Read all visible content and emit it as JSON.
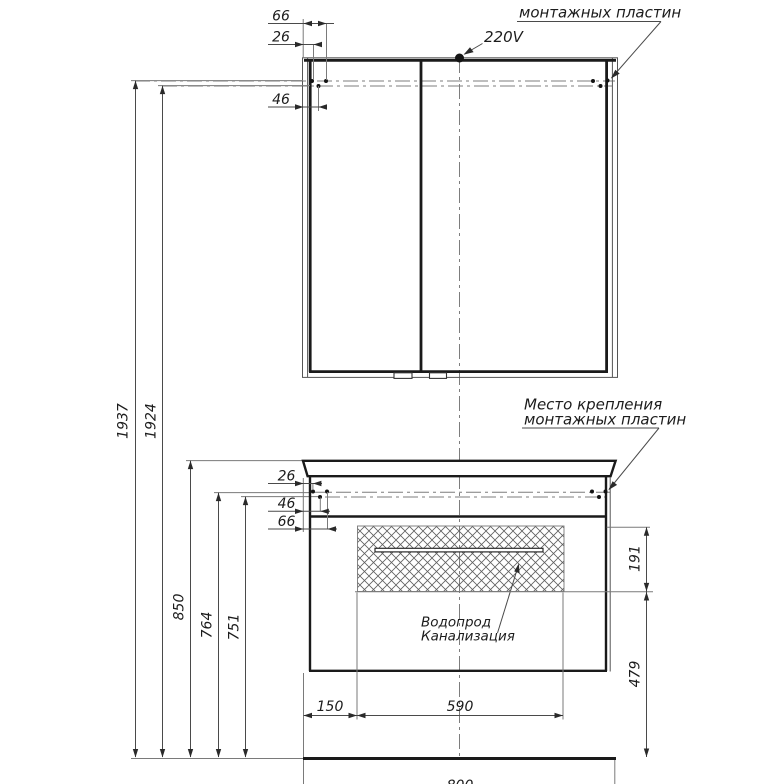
{
  "drawing": {
    "type": "furniture installation technical drawing",
    "units": "mm",
    "annotations": {
      "power": "220V",
      "mounting_plates_top": "монтажных пластин",
      "mounting_place_line1": "Место крепления",
      "mounting_place_line2": "монтажных пластин",
      "utilities_line1": "Водопрод",
      "utilities_line2": "Канализация"
    },
    "dims": {
      "mirror_top": {
        "d66": "66",
        "d26": "26",
        "d46": "46"
      },
      "heights": {
        "d1937": "1937",
        "d1924": "1924",
        "d850": "850",
        "d764": "764",
        "d751": "751"
      },
      "vanity_left": {
        "d26": "26",
        "d46": "46",
        "d66": "66"
      },
      "vanity_right": {
        "d191": "191",
        "d479": "479"
      },
      "widths": {
        "d150": "150",
        "d590": "590",
        "d800": "800"
      }
    },
    "colors": {
      "background": "#ffffff",
      "object_line": "#1a1a1a",
      "thin_line": "#7a7a7a",
      "text": "#1c1c1c"
    }
  }
}
